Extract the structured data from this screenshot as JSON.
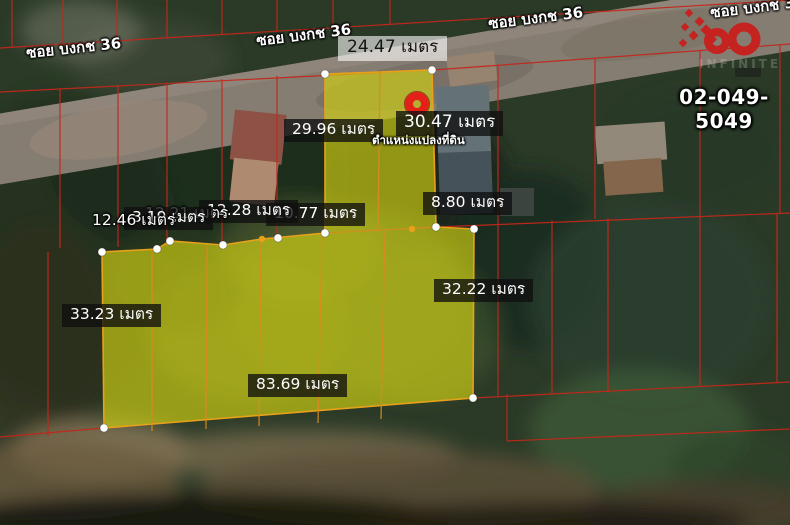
{
  "map": {
    "streets": [
      {
        "label": "ซอย บงกช 36"
      },
      {
        "label": "ซอย บงกช 36"
      },
      {
        "label": "ซอย บงกช 36"
      },
      {
        "label": "ซอย บงกช 36"
      }
    ],
    "measurements": [
      {
        "label": "24.47 เมตร"
      },
      {
        "label": "29.96 เมตร"
      },
      {
        "label": "30.47 เมตร"
      },
      {
        "label": "8.80 เมตร"
      },
      {
        "label": "10.77 เมตร"
      },
      {
        "label": "12.28 เมตร"
      },
      {
        "label": "12.21 เมตร"
      },
      {
        "label": "3.19 เมตร"
      },
      {
        "label": "12.46 เมตร"
      },
      {
        "label": "33.23 เมตร"
      },
      {
        "label": "32.22 เมตร"
      },
      {
        "label": "83.69 เมตร"
      }
    ],
    "pin_caption": "ตำแหน่งแปลงที่ดิน",
    "phone": "02-049-5049",
    "logo_watermark": "INFINITE",
    "colors": {
      "plot_fill": "#d2d212",
      "boundary_red": "#c3271b",
      "divider_orange": "#d98b1f",
      "pin_red": "#e42119"
    }
  }
}
